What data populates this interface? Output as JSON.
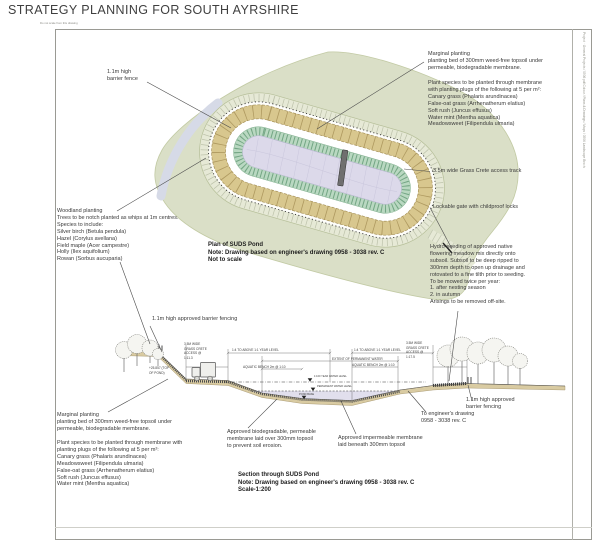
{
  "page": {
    "title": "STRATEGY PLANNING FOR SOUTH AYRSHIRE",
    "no_scale": "Do not scale from this drawing",
    "side_note": "Project · General Projects / 0506 pdf Colour / Plans & Drawings / Maps / 0506 Landscape Broch"
  },
  "colors": {
    "woodland": "#dadfc7",
    "road": "#d6dae7",
    "track": "#e6e9d6",
    "marginal": "#d8c78e",
    "aquatic": "#b9d8c1",
    "water": "#dcd9ea",
    "soil": "#d9cba2"
  },
  "plan": {
    "fence_label": "1.1m high\nbarrier fence",
    "marginal_block": [
      "Marginal planting",
      "planting bed of 300mm weed-free topsoil under",
      "permeable, biodegradable membrane."
    ],
    "species_block": [
      "Plant species to be planted through membrane",
      "with planting plugs of the following at 5 per m²:",
      "Canary grass (Phalaris arundinacea)",
      "False-oat grass (Arrhenatherum elatius)",
      "Soft rush (Juncus effusus)",
      "Water mint (Mentha aquatica)",
      "Meadowsweet (Filipendula ulmaria)"
    ],
    "access_track": "3.5m wide Grass Crete access track",
    "gate": "Lockable gate with childproof locks",
    "woodland_block": [
      "Woodland planting",
      "Trees to be notch planted as whips at 1m centres.",
      "Species to include:",
      "Silver birch (Betula pendula)",
      "Hazel (Corylus avellana)",
      "Field maple (Acer campestre)",
      "Holly (Ilex aquifolium)",
      "Rowan (Sorbus aucuparia)"
    ],
    "hydroseed_block": [
      "Hydro-seeding of approved native",
      "flowering meadow mix directly onto",
      "subsoil. Subsoil to be deep ripped to",
      "300mm depth to open up drainage and",
      "rotovated to a fine tilth prior to seeding.",
      "To be mowed twice per year:",
      "1. after nesting season",
      "2. in autumn",
      "Arisings to be removed off-site."
    ],
    "caption": {
      "title": "Plan of SUDS Pond",
      "note": "Note: Drawing based on engineer's drawing 0958 - 3038 rev. C",
      "scale": "Not to scale"
    }
  },
  "section": {
    "fencing_left": "1.1m high approved barrier fencing",
    "dims": {
      "track_left": "3.5M WIDE\nGRASS CRETE\nACCESS @\n1:11.3",
      "top_of_pond": "+25.857 (TOP\nOF POND)",
      "year_left": "1:4 TO ABOVE 1:1 YEAR LEVEL",
      "year_right": "1:4 TO ABOVE 1:1 YEAR LEVEL",
      "extent": "EXTENT OF PERMANENT WATER",
      "aquatic_left": "AQUATIC BENCH 2m @ 1:10",
      "aquatic_right": "AQUATIC BENCH 2m @ 1:10",
      "track_right": "3.5M WIDE\nGRASS CRETE\nACCESS @\n1:17.5",
      "level_100yr": "1:100 YEAR WATER LEVEL",
      "level_perm": "PERMANENT WATER LEVEL",
      "level_base": "POND BASE"
    },
    "marginal_block": [
      "Marginal planting",
      "planting bed of 300mm weed-free topsoil under",
      "permeable, biodegradable membrane."
    ],
    "species_block": [
      "Plant species to be planted through membrane with",
      "planting plugs of the following at 5 per m²:",
      "Canary grass (Phalaris arundinacea)",
      "Meadowsweet (Filipendula ulmaria)",
      "False-oat grass (Arrhenatherum elatius)",
      "Soft rush (Juncus effusus)",
      "Water mint (Mentha aquatica)"
    ],
    "membrane_perm": "Approved biodegradable, permeable\nmembrane laid over 300mm topsoil\nto prevent soil erosion.",
    "membrane_imperm": "Approved impermeable membrane\nlaid beneath 300mm topsoil",
    "engineer_ref": "To engineer's drawing\n0958 - 3038 rev. C",
    "fencing_right": "1.1m high approved\nbarrier fencing",
    "caption": {
      "title": "Section through SUDS Pond",
      "note": "Note: Drawing based on engineer's drawing 0958 - 3038 rev. C",
      "scale": "Scale-1:200"
    }
  }
}
